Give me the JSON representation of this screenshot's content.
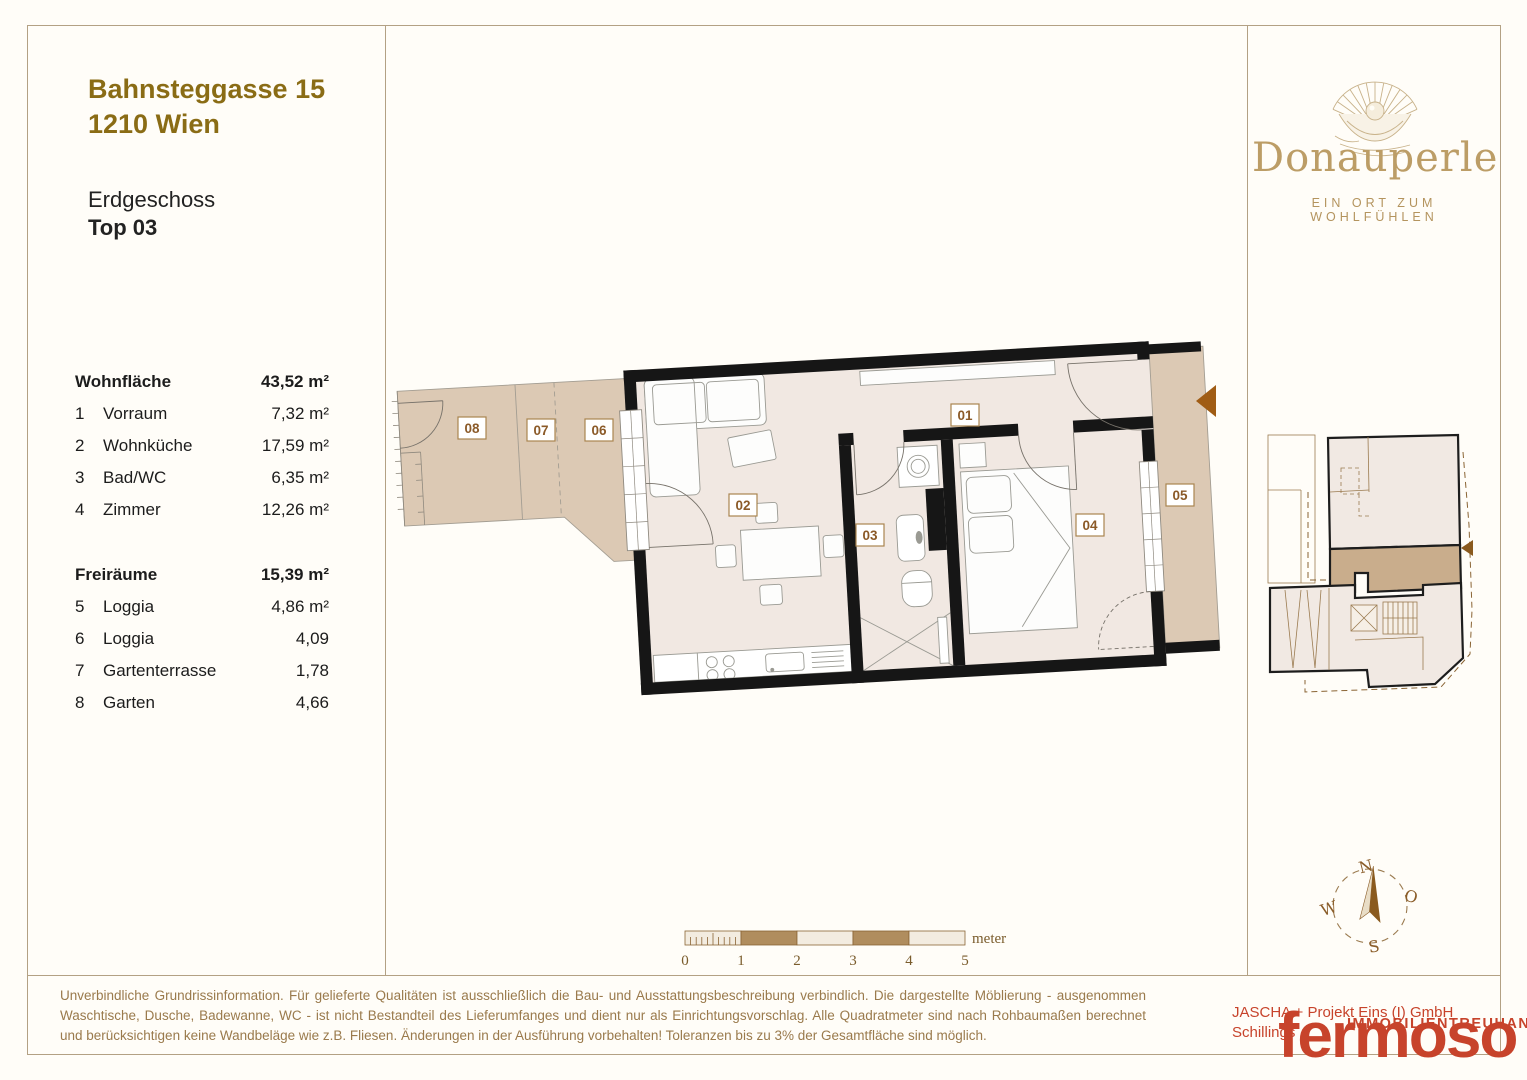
{
  "header": {
    "address_line1": "Bahnsteggasse 15",
    "address_line2": "1210 Wien",
    "floor": "Erdgeschoss",
    "unit": "Top 03"
  },
  "area_table": {
    "sections": [
      {
        "title": "Wohnfläche",
        "total": "43,52 m²",
        "rows": [
          [
            "1",
            "Vorraum",
            "7,32 m²"
          ],
          [
            "2",
            "Wohnküche",
            "17,59 m²"
          ],
          [
            "3",
            "Bad/WC",
            "6,35 m²"
          ],
          [
            "4",
            "Zimmer",
            "12,26 m²"
          ]
        ]
      },
      {
        "title": "Freiräume",
        "total": "15,39 m²",
        "rows": [
          [
            "5",
            "Loggia",
            "4,86 m²"
          ],
          [
            "6",
            "Loggia",
            "4,09"
          ],
          [
            "7",
            "Gartenterrasse",
            "1,78"
          ],
          [
            "8",
            "Garten",
            "4,66"
          ]
        ]
      }
    ]
  },
  "brand": {
    "name": "Donauperle",
    "tagline": "EIN ORT ZUM WOHLFÜHLEN",
    "logo_icon": "pearl-shell-icon"
  },
  "plan": {
    "rooms": [
      "01",
      "02",
      "03",
      "04",
      "05",
      "06",
      "07",
      "08"
    ],
    "entrance_marker": "entrance-arrow"
  },
  "scalebar": {
    "ticks": [
      "0",
      "1",
      "2",
      "3",
      "4",
      "5"
    ],
    "unit": "meter"
  },
  "compass": {
    "north": "N",
    "east": "O",
    "south": "S",
    "west": "W"
  },
  "footer": {
    "disclaimer": "Unverbindliche Grundrissinformation. Für gelieferte Qualitäten ist ausschließlich die Bau- und Ausstattungsbeschreibung verbindlich. Die dargestellte Möblierung - ausgenommen Waschtische, Dusche, Badewanne, WC - ist nicht Bestandteil des Lieferumfanges und dient nur als Einrichtungsvorschlag. Alle Quadratmeter sind nach Rohbaumaßen berechnet und berücksichtigen keine Wandbeläge wie z.B. Fliesen. Änderungen in der Ausführung vorbehalten! Toleranzen bis zu 3% der Gesamtfläche sind möglich.",
    "company_line1": "JASCHA + Projekt Eins (I) GmbH",
    "company_line2": "Schillings",
    "company_line3": "IMMOBILIENTREUHAND",
    "logo_text": "fermoso"
  },
  "colors": {
    "accent_gold": "#8a6c15",
    "brand_gold": "#bc9d66",
    "outdoor_tan": "#dcc9b4",
    "interior_beige": "#f1e8e2",
    "wall_black": "#161616",
    "scale_brown": "#b08d5e",
    "logo_red": "#c7432b",
    "frame_line": "#b3a184"
  }
}
